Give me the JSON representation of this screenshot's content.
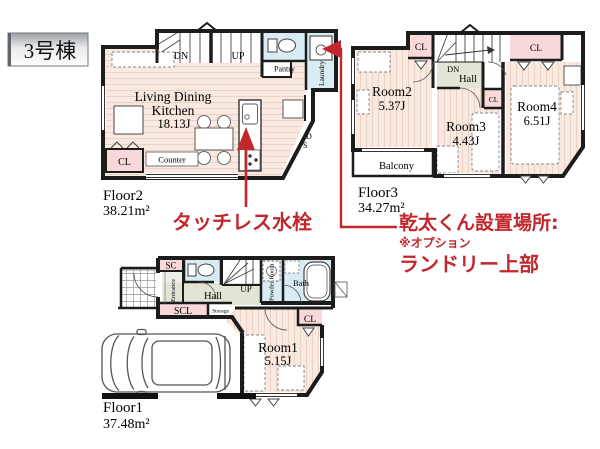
{
  "building_label": "3号棟",
  "floor2": {
    "name": "Floor2",
    "area": "38.21m²",
    "ldk_line1": "Living Dining",
    "ldk_line2": "Kitchen",
    "ldk_size": "18.13J",
    "dn": "DN",
    "up": "UP",
    "pantry": "Pantry",
    "laundry": "Laundry",
    "cl": "CL",
    "counter": "Counter",
    "ds_d": "D",
    "ds_s": "S"
  },
  "floor3": {
    "name": "Floor3",
    "area": "34.27m²",
    "room2": "Room2",
    "room2_size": "5.37J",
    "room3": "Room3",
    "room3_size": "4.43J",
    "room4": "Room4",
    "room4_size": "6.51J",
    "balcony": "Balcony",
    "dn": "DN",
    "hall": "Hall",
    "cl_left": "CL",
    "cl_mid": "CL",
    "cl_right": "CL"
  },
  "floor1": {
    "name": "Floor1",
    "area": "37.48m²",
    "sc": "SC",
    "scl": "SCL",
    "storage": "Storage",
    "entrance": "Entrance",
    "hall": "Hall",
    "up": "UP",
    "powder": "Powder Room",
    "bath": "Bath",
    "room1": "Room1",
    "room1_size": "5.15J",
    "cl": "CL"
  },
  "annotations": {
    "faucet": "タッチレス水栓",
    "dryer_title": "乾太くん設置場所:",
    "dryer_note": "※オプション",
    "dryer_place": "ランドリー上部"
  },
  "colors": {
    "red": "#c1272d",
    "wall": "#1c1c1c",
    "floor": "#f9e9e0",
    "floor_stripe": "#e9d2c6",
    "wet": "#d9ecf4",
    "closet": "#f8d8d8",
    "hall": "#e2e5d5"
  }
}
